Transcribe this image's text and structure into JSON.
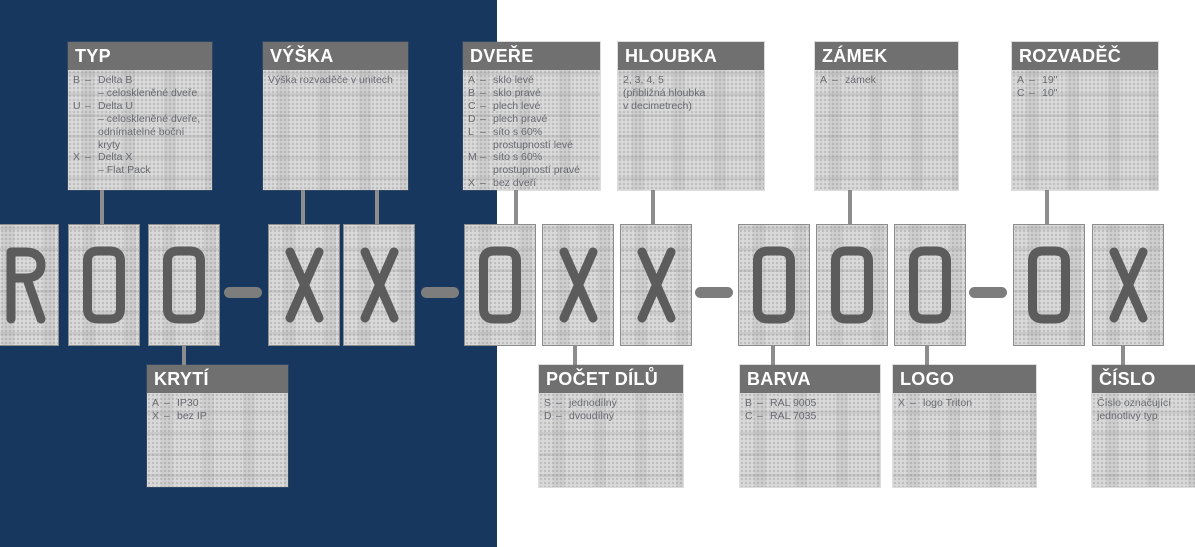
{
  "sep": "–",
  "code": "R00–XX–0XX–000–0X",
  "colors": {
    "navy_panel": "#17375e",
    "white_panel": "#ffffff",
    "callout_header_bg": "#707070",
    "callout_header_text": "#ffffff",
    "callout_body_bg": "#d9d9d9",
    "callout_body_text": "#696b70",
    "block_glyph": "#5c5c5c",
    "block_border": "#8c8c8c",
    "connector": "#8d8d8d",
    "dash": "#7d7d7d"
  },
  "top_boxes": [
    {
      "id": "typ",
      "title": "TYP",
      "x": 68,
      "w": 144,
      "connectors": [
        102
      ],
      "lines": [
        {
          "c": "B",
          "t": "Delta B"
        },
        {
          "c": "",
          "t": "– celoskleněné dveře"
        },
        {
          "c": "U",
          "t": "Delta U"
        },
        {
          "c": "",
          "t": "– celoskleněné dveře,"
        },
        {
          "c": "",
          "t": "odnímatelné boční"
        },
        {
          "c": "",
          "t": "kryty"
        },
        {
          "c": "X",
          "t": "Delta X"
        },
        {
          "c": "",
          "t": "– Flat Pack"
        }
      ]
    },
    {
      "id": "vyska",
      "title": "VÝŠKA",
      "x": 263,
      "w": 145,
      "connectors": [
        303,
        377
      ],
      "lines": [
        {
          "t": "Výška rozvaděče v unitech"
        }
      ]
    },
    {
      "id": "dvere",
      "title": "DVEŘE",
      "x": 463,
      "w": 137,
      "connectors": [
        516
      ],
      "lines": [
        {
          "c": "A",
          "t": "sklo levé"
        },
        {
          "c": "B",
          "t": "sklo pravé"
        },
        {
          "c": "C",
          "t": "plech levé"
        },
        {
          "c": "D",
          "t": "plech pravé"
        },
        {
          "c": "L",
          "t": "síto s 60%"
        },
        {
          "c": "",
          "t": "prostupností levé"
        },
        {
          "c": "M",
          "t": "síto s 60%"
        },
        {
          "c": "",
          "t": "prostupností pravé"
        },
        {
          "c": "X",
          "t": "bez dveří"
        }
      ]
    },
    {
      "id": "hloubka",
      "title": "HLOUBKA",
      "x": 618,
      "w": 146,
      "connectors": [
        653
      ],
      "lines": [
        {
          "t": "2, 3, 4, 5"
        },
        {
          "t": "(přibližná hloubka"
        },
        {
          "t": "v decimetrech)"
        }
      ]
    },
    {
      "id": "zamek",
      "title": "ZÁMEK",
      "x": 815,
      "w": 143,
      "connectors": [
        850
      ],
      "lines": [
        {
          "c": "A",
          "t": "zámek"
        }
      ]
    },
    {
      "id": "rozvadec",
      "title": "ROZVADĚČ",
      "x": 1012,
      "w": 146,
      "connectors": [
        1047
      ],
      "lines": [
        {
          "c": "A",
          "t": "19\""
        },
        {
          "c": "C",
          "t": "10\""
        }
      ]
    }
  ],
  "bottom_boxes": [
    {
      "id": "kryti",
      "title": "KRYTÍ",
      "x": 147,
      "w": 141,
      "connectors": [
        184
      ],
      "lines": [
        {
          "c": "A",
          "t": "IP30"
        },
        {
          "c": "X",
          "t": "bez IP"
        }
      ]
    },
    {
      "id": "pocet-dilu",
      "title": "POČET DÍLŮ",
      "x": 539,
      "w": 144,
      "connectors": [
        575
      ],
      "lines": [
        {
          "c": "S",
          "t": "jednodílný"
        },
        {
          "c": "D",
          "t": "dvoudílný"
        }
      ]
    },
    {
      "id": "barva",
      "title": "BARVA",
      "x": 740,
      "w": 140,
      "connectors": [
        773
      ],
      "lines": [
        {
          "c": "B",
          "t": "RAL 9005"
        },
        {
          "c": "C",
          "t": "RAL 7035"
        }
      ]
    },
    {
      "id": "logo",
      "title": "LOGO",
      "x": 893,
      "w": 143,
      "connectors": [
        927
      ],
      "lines": [
        {
          "c": "X",
          "t": "logo Triton"
        }
      ]
    },
    {
      "id": "cislo",
      "title": "ČÍSLO",
      "x": 1092,
      "w": 103,
      "connectors": [
        1123
      ],
      "lines": [
        {
          "t": "Číslo označující"
        },
        {
          "t": "jednotlivý typ"
        }
      ]
    }
  ],
  "blocks": [
    {
      "glyph": "R",
      "x": -13
    },
    {
      "glyph": "0",
      "x": 68
    },
    {
      "glyph": "0",
      "x": 148
    },
    {
      "glyph": "X",
      "x": 268
    },
    {
      "glyph": "X",
      "x": 343
    },
    {
      "glyph": "0",
      "x": 464
    },
    {
      "glyph": "X",
      "x": 542
    },
    {
      "glyph": "X",
      "x": 620
    },
    {
      "glyph": "0",
      "x": 738
    },
    {
      "glyph": "0",
      "x": 816
    },
    {
      "glyph": "0",
      "x": 894
    },
    {
      "glyph": "0",
      "x": 1013
    },
    {
      "glyph": "X",
      "x": 1092
    }
  ],
  "dashes": [
    {
      "x": 224
    },
    {
      "x": 421
    },
    {
      "x": 695
    },
    {
      "x": 969
    }
  ]
}
